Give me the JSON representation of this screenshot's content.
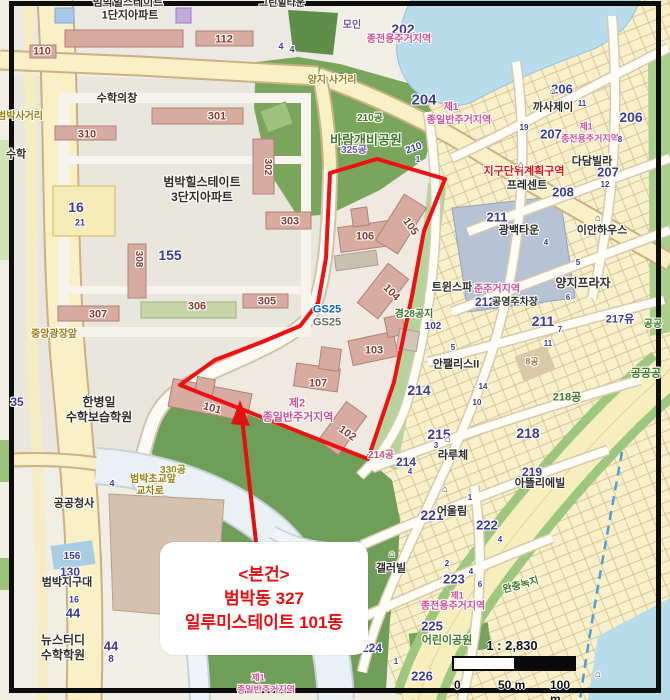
{
  "map": {
    "callout": {
      "line1": "<본건>",
      "line2": "범박동 327",
      "line3": "일루미스테이트 101동"
    },
    "scale_bar": {
      "ratio": "1 : 2,830",
      "tick0": "0",
      "tick50": "50 m",
      "tick100": "100 m"
    },
    "palette": {
      "dong": "#8a3a3a",
      "lot": "#3c3c9b",
      "name": "#2e2e2e",
      "road": "#9b7d18",
      "zone": "#d0509b",
      "red": "#e81313",
      "green": "#3e7a2e",
      "purple": "#6a55a8",
      "blue": "#0a62d0",
      "gray": "#6b6b6b",
      "olive": "#8a8a20",
      "tan": "#9a7f56",
      "pinkred": "#c4537c",
      "icon": "#3a3a3a",
      "boundary": "#ee1111",
      "callout_text": "#e60f0f"
    },
    "labels": [
      {
        "t": "범박힐스테이트",
        "x": 128,
        "y": 3,
        "s": 11,
        "c": "name"
      },
      {
        "t": "1단지아파트",
        "x": 130,
        "y": 16,
        "s": 11,
        "c": "name"
      },
      {
        "t": "그린힐타운",
        "x": 282,
        "y": 4,
        "s": 10,
        "c": "name"
      },
      {
        "t": "110",
        "x": 42,
        "y": 52,
        "s": 11,
        "c": "dong"
      },
      {
        "t": "112",
        "x": 224,
        "y": 40,
        "s": 11,
        "c": "dong"
      },
      {
        "t": "모인",
        "x": 352,
        "y": 26,
        "s": 10,
        "c": "purple"
      },
      {
        "t": "202",
        "x": 403,
        "y": 29,
        "s": 14,
        "c": "lot"
      },
      {
        "t": "종전용주거지역",
        "x": 399,
        "y": 40,
        "s": 10,
        "c": "zone"
      },
      {
        "t": "4",
        "x": 281,
        "y": 47,
        "s": 9,
        "c": "lot"
      },
      {
        "t": "4",
        "x": 292,
        "y": 50,
        "s": 9,
        "c": "lot"
      },
      {
        "t": "양지 사거리",
        "x": 332,
        "y": 81,
        "s": 10,
        "c": "road"
      },
      {
        "t": "수학의창",
        "x": 117,
        "y": 99,
        "s": 11,
        "c": "name"
      },
      {
        "t": "301",
        "x": 217,
        "y": 117,
        "s": 11,
        "c": "dong"
      },
      {
        "t": "310",
        "x": 87,
        "y": 135,
        "s": 11,
        "c": "dong"
      },
      {
        "t": "범박사거리",
        "x": 20,
        "y": 117,
        "s": 10,
        "c": "road"
      },
      {
        "t": "수학",
        "x": 16,
        "y": 155,
        "s": 11,
        "c": "name"
      },
      {
        "t": "204",
        "x": 424,
        "y": 100,
        "s": 15,
        "c": "lot"
      },
      {
        "t": "제1",
        "x": 451,
        "y": 108,
        "s": 10,
        "c": "zone"
      },
      {
        "t": "종일반주거지역",
        "x": 459,
        "y": 121,
        "s": 10,
        "c": "zone"
      },
      {
        "t": "210공",
        "x": 370,
        "y": 119,
        "s": 10,
        "c": "green"
      },
      {
        "t": "바람개비공원",
        "x": 366,
        "y": 140,
        "s": 13,
        "c": "green"
      },
      {
        "t": "325공",
        "x": 354,
        "y": 151,
        "s": 10,
        "c": "purple"
      },
      {
        "t": "210",
        "x": 414,
        "y": 149,
        "s": 10,
        "c": "lot",
        "r": -20
      },
      {
        "t": "1",
        "x": 418,
        "y": 160,
        "s": 8,
        "c": "lot"
      },
      {
        "t": "까사제이",
        "x": 553,
        "y": 108,
        "s": 11,
        "c": "name"
      },
      {
        "t": "206",
        "x": 562,
        "y": 89,
        "s": 13,
        "c": "lot"
      },
      {
        "t": "11",
        "x": 582,
        "y": 104,
        "s": 8,
        "c": "lot"
      },
      {
        "t": "206",
        "x": 631,
        "y": 117,
        "s": 14,
        "c": "lot"
      },
      {
        "t": "제1",
        "x": 586,
        "y": 127,
        "s": 9,
        "c": "zone"
      },
      {
        "t": "종전용주거지역",
        "x": 590,
        "y": 139,
        "s": 9,
        "c": "zone"
      },
      {
        "t": "207",
        "x": 551,
        "y": 134,
        "s": 13,
        "c": "lot"
      },
      {
        "t": "19",
        "x": 524,
        "y": 128,
        "s": 8,
        "c": "lot"
      },
      {
        "t": "다담빌라",
        "x": 592,
        "y": 162,
        "s": 11,
        "c": "name"
      },
      {
        "t": "207",
        "x": 608,
        "y": 172,
        "s": 13,
        "c": "lot"
      },
      {
        "t": "8",
        "x": 620,
        "y": 140,
        "s": 8,
        "c": "lot"
      },
      {
        "t": "12",
        "x": 605,
        "y": 185,
        "s": 8,
        "c": "lot"
      },
      {
        "t": "지구단위계획구역",
        "x": 524,
        "y": 172,
        "s": 11,
        "c": "red"
      },
      {
        "t": "프레센트",
        "x": 527,
        "y": 186,
        "s": 11,
        "c": "name"
      },
      {
        "t": "208",
        "x": 563,
        "y": 192,
        "s": 13,
        "c": "lot"
      },
      {
        "t": "211",
        "x": 497,
        "y": 217,
        "s": 13,
        "c": "lot"
      },
      {
        "t": "광백타운",
        "x": 519,
        "y": 231,
        "s": 11,
        "c": "name"
      },
      {
        "t": "이안하우스",
        "x": 602,
        "y": 231,
        "s": 11,
        "c": "name"
      },
      {
        "t": "4",
        "x": 546,
        "y": 243,
        "s": 8,
        "c": "lot"
      },
      {
        "t": "5",
        "x": 578,
        "y": 263,
        "s": 8,
        "c": "lot"
      },
      {
        "t": "양지프라자",
        "x": 583,
        "y": 283,
        "s": 12,
        "c": "name"
      },
      {
        "t": "6",
        "x": 568,
        "y": 298,
        "s": 8,
        "c": "lot"
      },
      {
        "t": "217유",
        "x": 620,
        "y": 320,
        "s": 11,
        "c": "lot"
      },
      {
        "t": "공공",
        "x": 653,
        "y": 325,
        "s": 10,
        "c": "green"
      },
      {
        "t": "트윈스파",
        "x": 452,
        "y": 288,
        "s": 11,
        "c": "name"
      },
      {
        "t": "준주거지역",
        "x": 497,
        "y": 290,
        "s": 10,
        "c": "zone"
      },
      {
        "t": "212",
        "x": 485,
        "y": 302,
        "s": 12,
        "c": "lot"
      },
      {
        "t": "공영주차장",
        "x": 515,
        "y": 303,
        "s": 10,
        "c": "name"
      },
      {
        "t": "211",
        "x": 543,
        "y": 321,
        "s": 14,
        "c": "lot"
      },
      {
        "t": "7",
        "x": 560,
        "y": 330,
        "s": 8,
        "c": "lot"
      },
      {
        "t": "경28공지",
        "x": 414,
        "y": 315,
        "s": 10,
        "c": "green"
      },
      {
        "t": "102",
        "x": 433,
        "y": 327,
        "s": 10,
        "c": "lot"
      },
      {
        "t": "11",
        "x": 548,
        "y": 344,
        "s": 8,
        "c": "lot"
      },
      {
        "t": "8공",
        "x": 532,
        "y": 362,
        "s": 9,
        "c": "tan"
      },
      {
        "t": "안팰리스II",
        "x": 456,
        "y": 365,
        "s": 11,
        "c": "name"
      },
      {
        "t": "5",
        "x": 453,
        "y": 348,
        "s": 8,
        "c": "lot"
      },
      {
        "t": "214",
        "x": 419,
        "y": 390,
        "s": 14,
        "c": "lot"
      },
      {
        "t": "14",
        "x": 483,
        "y": 387,
        "s": 8,
        "c": "lot"
      },
      {
        "t": "10",
        "x": 477,
        "y": 403,
        "s": 8,
        "c": "lot"
      },
      {
        "t": "218공",
        "x": 567,
        "y": 398,
        "s": 11,
        "c": "green"
      },
      {
        "t": "공공공",
        "x": 646,
        "y": 374,
        "s": 11,
        "c": "green"
      },
      {
        "t": "218",
        "x": 528,
        "y": 433,
        "s": 14,
        "c": "lot"
      },
      {
        "t": "215",
        "x": 439,
        "y": 434,
        "s": 14,
        "c": "lot"
      },
      {
        "t": "3",
        "x": 436,
        "y": 446,
        "s": 8,
        "c": "lot"
      },
      {
        "t": "라루체",
        "x": 453,
        "y": 456,
        "s": 11,
        "c": "name"
      },
      {
        "t": "214공",
        "x": 381,
        "y": 456,
        "s": 10,
        "c": "pinkred"
      },
      {
        "t": "214",
        "x": 406,
        "y": 462,
        "s": 12,
        "c": "lot"
      },
      {
        "t": "4",
        "x": 410,
        "y": 472,
        "s": 8,
        "c": "lot"
      },
      {
        "t": "219",
        "x": 532,
        "y": 472,
        "s": 12,
        "c": "lot"
      },
      {
        "t": "아뜰리에빌",
        "x": 540,
        "y": 484,
        "s": 11,
        "c": "name"
      },
      {
        "t": "221",
        "x": 432,
        "y": 515,
        "s": 14,
        "c": "lot"
      },
      {
        "t": "어울림",
        "x": 452,
        "y": 512,
        "s": 11,
        "c": "name"
      },
      {
        "t": "222",
        "x": 487,
        "y": 525,
        "s": 13,
        "c": "lot"
      },
      {
        "t": "1",
        "x": 470,
        "y": 498,
        "s": 8,
        "c": "lot"
      },
      {
        "t": "4",
        "x": 500,
        "y": 540,
        "s": 8,
        "c": "lot"
      },
      {
        "t": "갤러빌",
        "x": 391,
        "y": 569,
        "s": 11,
        "c": "name"
      },
      {
        "t": "223",
        "x": 454,
        "y": 579,
        "s": 13,
        "c": "lot"
      },
      {
        "t": "4",
        "x": 471,
        "y": 572,
        "s": 8,
        "c": "lot"
      },
      {
        "t": "6",
        "x": 480,
        "y": 585,
        "s": 8,
        "c": "lot"
      },
      {
        "t": "2",
        "x": 447,
        "y": 564,
        "s": 8,
        "c": "lot"
      },
      {
        "t": "제1",
        "x": 457,
        "y": 596,
        "s": 9,
        "c": "zone"
      },
      {
        "t": "종전용주거지역",
        "x": 453,
        "y": 607,
        "s": 10,
        "c": "zone"
      },
      {
        "t": "완충녹지",
        "x": 521,
        "y": 586,
        "s": 10,
        "c": "green",
        "r": -15
      },
      {
        "t": "225",
        "x": 432,
        "y": 626,
        "s": 13,
        "c": "lot"
      },
      {
        "t": "어린이공원",
        "x": 447,
        "y": 641,
        "s": 11,
        "c": "green"
      },
      {
        "t": "224",
        "x": 372,
        "y": 648,
        "s": 12,
        "c": "lot"
      },
      {
        "t": "226",
        "x": 422,
        "y": 676,
        "s": 13,
        "c": "lot"
      },
      {
        "t": "1",
        "x": 396,
        "y": 662,
        "s": 8,
        "c": "lot"
      },
      {
        "t": "제1",
        "x": 258,
        "y": 678,
        "s": 9,
        "c": "zone"
      },
      {
        "t": "종일반주거지역",
        "x": 266,
        "y": 690,
        "s": 9,
        "c": "zone"
      },
      {
        "t": "범박힐스테이트",
        "x": 202,
        "y": 182,
        "s": 12,
        "c": "name"
      },
      {
        "t": "3단지아파트",
        "x": 202,
        "y": 197,
        "s": 12,
        "c": "name"
      },
      {
        "t": "302",
        "x": 267,
        "y": 167,
        "s": 10,
        "c": "dong",
        "r": 90
      },
      {
        "t": "303",
        "x": 290,
        "y": 222,
        "s": 11,
        "c": "dong"
      },
      {
        "t": "16",
        "x": 76,
        "y": 207,
        "s": 14,
        "c": "lot"
      },
      {
        "t": "21",
        "x": 80,
        "y": 223,
        "s": 9,
        "c": "lot"
      },
      {
        "t": "155",
        "x": 170,
        "y": 255,
        "s": 14,
        "c": "lot"
      },
      {
        "t": "308",
        "x": 138,
        "y": 259,
        "s": 10,
        "c": "dong",
        "r": 90
      },
      {
        "t": "306",
        "x": 197,
        "y": 307,
        "s": 11,
        "c": "dong"
      },
      {
        "t": "305",
        "x": 267,
        "y": 302,
        "s": 11,
        "c": "dong"
      },
      {
        "t": "307",
        "x": 98,
        "y": 315,
        "s": 11,
        "c": "dong"
      },
      {
        "t": "중앙광장앞",
        "x": 54,
        "y": 335,
        "s": 10,
        "c": "road"
      },
      {
        "t": "35",
        "x": 17,
        "y": 402,
        "s": 12,
        "c": "lot"
      },
      {
        "t": "한병일",
        "x": 99,
        "y": 402,
        "s": 12,
        "c": "name"
      },
      {
        "t": "수학보습학원",
        "x": 99,
        "y": 417,
        "s": 12,
        "c": "name"
      },
      {
        "t": "GS25",
        "x": 327,
        "y": 310,
        "s": 11,
        "c": "blue",
        "n": "gs25-store-label"
      },
      {
        "t": "GS25",
        "x": 327,
        "y": 323,
        "s": 11,
        "c": "gray",
        "n": "gs25-store-label"
      },
      {
        "t": "106",
        "x": 365,
        "y": 237,
        "s": 11,
        "c": "dong"
      },
      {
        "t": "105",
        "x": 410,
        "y": 227,
        "s": 11,
        "c": "dong",
        "r": 55
      },
      {
        "t": "104",
        "x": 391,
        "y": 293,
        "s": 11,
        "c": "dong",
        "r": 45
      },
      {
        "t": "103",
        "x": 374,
        "y": 351,
        "s": 11,
        "c": "dong"
      },
      {
        "t": "107",
        "x": 318,
        "y": 384,
        "s": 11,
        "c": "dong"
      },
      {
        "t": "102",
        "x": 347,
        "y": 434,
        "s": 11,
        "c": "dong",
        "r": 35
      },
      {
        "t": "101",
        "x": 212,
        "y": 409,
        "s": 11,
        "c": "dong",
        "r": 15
      },
      {
        "t": "제2",
        "x": 297,
        "y": 404,
        "s": 11,
        "c": "zone"
      },
      {
        "t": "종일반주거지역",
        "x": 298,
        "y": 418,
        "s": 11,
        "c": "zone"
      },
      {
        "t": "330공",
        "x": 173,
        "y": 471,
        "s": 10,
        "c": "olive"
      },
      {
        "t": "범박초교앞",
        "x": 153,
        "y": 480,
        "s": 10,
        "c": "road"
      },
      {
        "t": "교차로",
        "x": 150,
        "y": 492,
        "s": 10,
        "c": "road"
      },
      {
        "t": "4",
        "x": 112,
        "y": 484,
        "s": 9,
        "c": "lot"
      },
      {
        "t": "공공청사",
        "x": 74,
        "y": 504,
        "s": 11,
        "c": "name"
      },
      {
        "t": "156",
        "x": 72,
        "y": 557,
        "s": 10,
        "c": "lot"
      },
      {
        "t": "130",
        "x": 70,
        "y": 572,
        "s": 12,
        "c": "lot"
      },
      {
        "t": "범박지구대",
        "x": 67,
        "y": 583,
        "s": 11,
        "c": "name"
      },
      {
        "t": "16",
        "x": 74,
        "y": 600,
        "s": 9,
        "c": "lot"
      },
      {
        "t": "44",
        "x": 73,
        "y": 613,
        "s": 13,
        "c": "lot"
      },
      {
        "t": "뉴스터디",
        "x": 63,
        "y": 640,
        "s": 12,
        "c": "name"
      },
      {
        "t": "수학학원",
        "x": 63,
        "y": 655,
        "s": 12,
        "c": "name"
      },
      {
        "t": "44",
        "x": 111,
        "y": 646,
        "s": 13,
        "c": "lot"
      },
      {
        "t": "8",
        "x": 111,
        "y": 660,
        "s": 10,
        "c": "lot"
      },
      {
        "t": "⌂",
        "x": 553,
        "y": 92,
        "s": 10,
        "c": "icon",
        "n": "house-icon"
      },
      {
        "t": "⌂",
        "x": 521,
        "y": 166,
        "s": 10,
        "c": "icon",
        "n": "house-icon"
      },
      {
        "t": "⌂",
        "x": 598,
        "y": 219,
        "s": 10,
        "c": "icon",
        "n": "house-icon"
      },
      {
        "t": "⌂",
        "x": 448,
        "y": 440,
        "s": 10,
        "c": "icon",
        "n": "house-icon"
      },
      {
        "t": "⌂",
        "x": 445,
        "y": 490,
        "s": 10,
        "c": "icon",
        "n": "house-icon"
      },
      {
        "t": "⌂",
        "x": 392,
        "y": 555,
        "s": 10,
        "c": "icon",
        "n": "house-icon"
      },
      {
        "t": "⌂",
        "x": 598,
        "y": 675,
        "s": 10,
        "c": "icon",
        "n": "house-icon"
      }
    ]
  }
}
